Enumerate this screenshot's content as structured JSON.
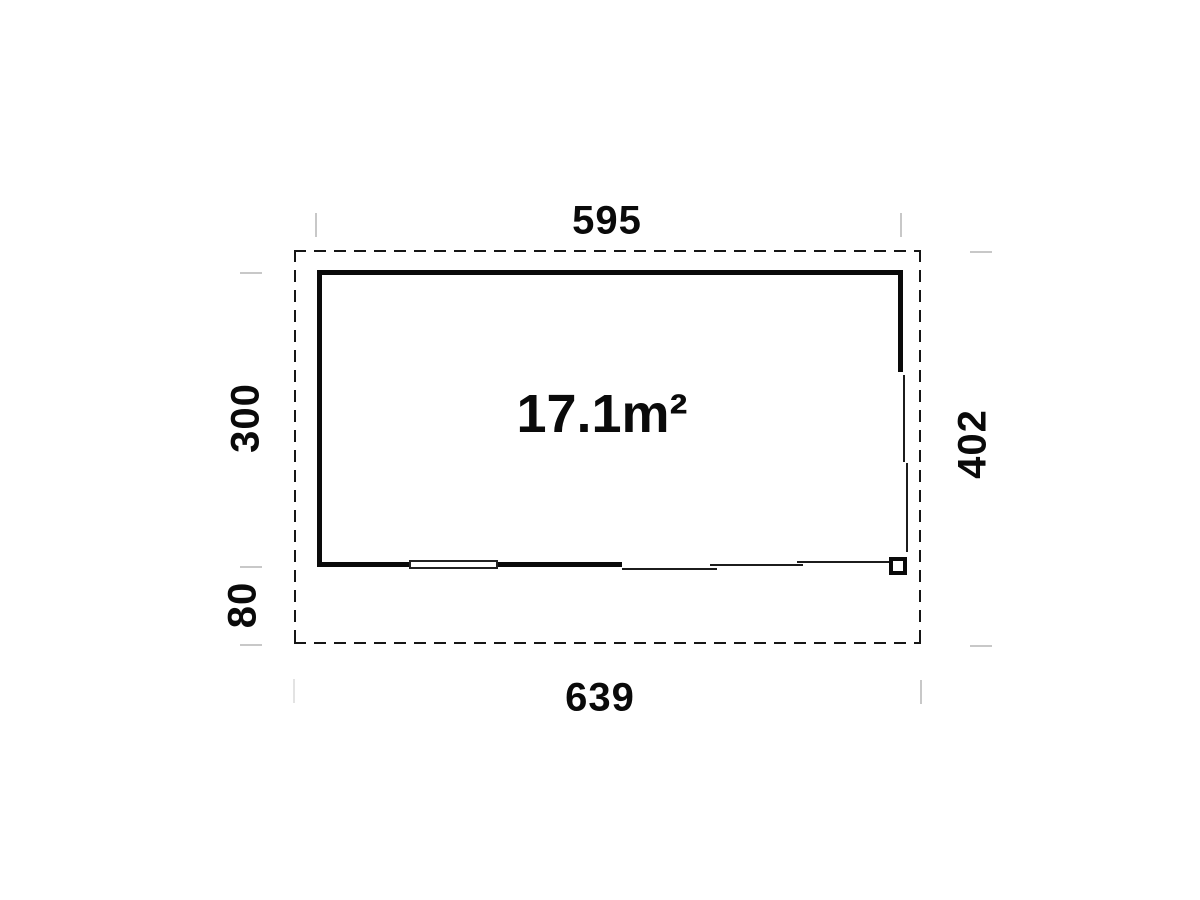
{
  "plan": {
    "area_label": "17.1m²",
    "dimensions": {
      "top_wall_width": "595",
      "room_depth": "300",
      "overhang_depth": "80",
      "overall_depth": "402",
      "overall_width": "639"
    },
    "colors": {
      "line": "#0a0a0a",
      "tick": "#c8c8c8",
      "background": "#ffffff"
    }
  }
}
